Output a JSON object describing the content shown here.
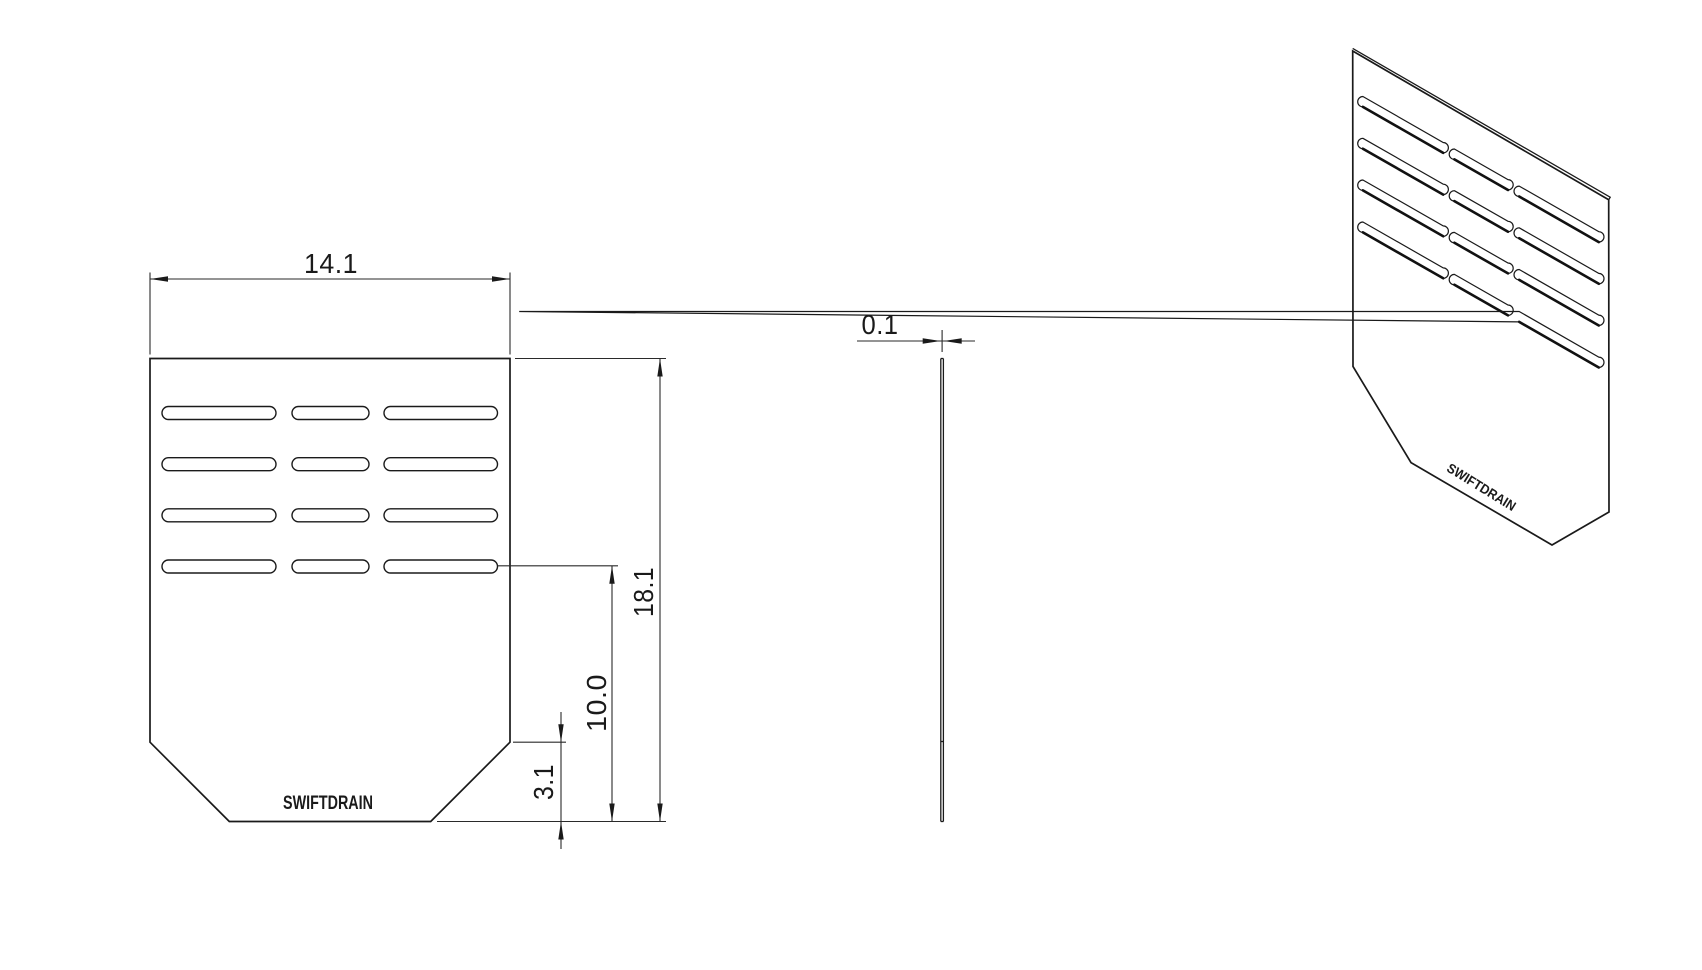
{
  "drawing": {
    "background": "#ffffff",
    "line_color": "#1a1a1a",
    "brand": "SWIFTDRAIN",
    "front_view": {
      "width_dim": "14.1",
      "height_dim": "18.1",
      "slot_offset_dim": "10.0",
      "chamfer_dim": "3.1",
      "label": "SWIFTDRAIN"
    },
    "side_view": {
      "thickness_dim": "0.1"
    },
    "iso_view": {
      "label": "SWIFTDRAIN"
    }
  }
}
